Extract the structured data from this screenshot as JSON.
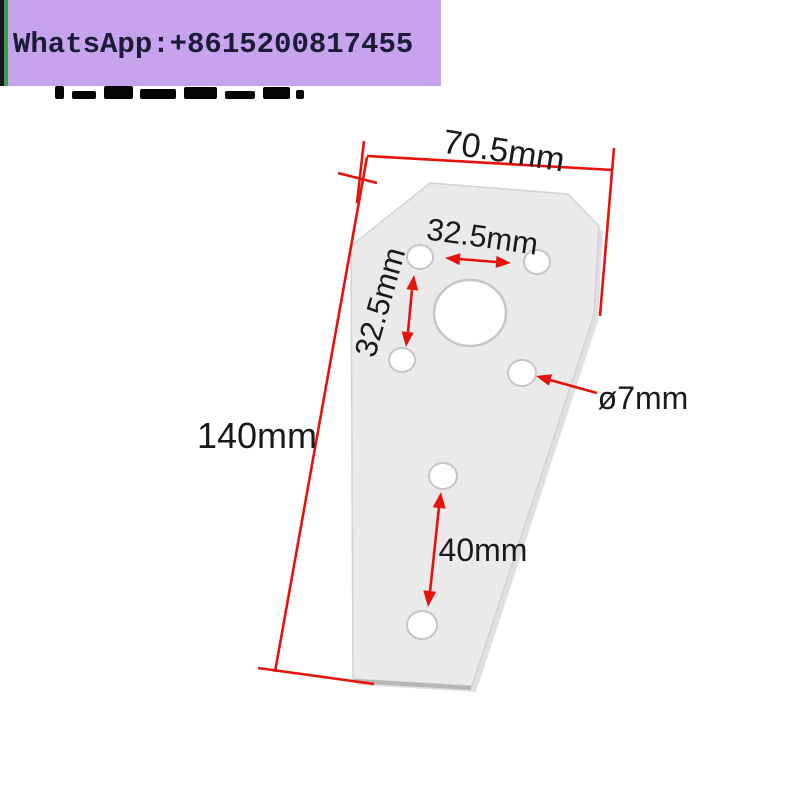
{
  "banner": {
    "contact_text": "WhatsApp:+8615200817455",
    "background_color": "#c7a3ee",
    "stripe_color": "#3f9b52",
    "text_color": "#1c1b38"
  },
  "diagram": {
    "type": "dimensioned-part-drawing",
    "part": "tapered aluminum mounting plate with 7 holes",
    "dimension_color": "#e8120c",
    "plate_color": "#eaeaea",
    "labels": {
      "top_width": "70.5mm",
      "hole_spacing_horizontal": "32.5mm",
      "hole_spacing_vertical": "32.5mm",
      "total_height": "140mm",
      "hole_diameter": "ø7mm",
      "lower_hole_spacing": "40mm"
    }
  }
}
